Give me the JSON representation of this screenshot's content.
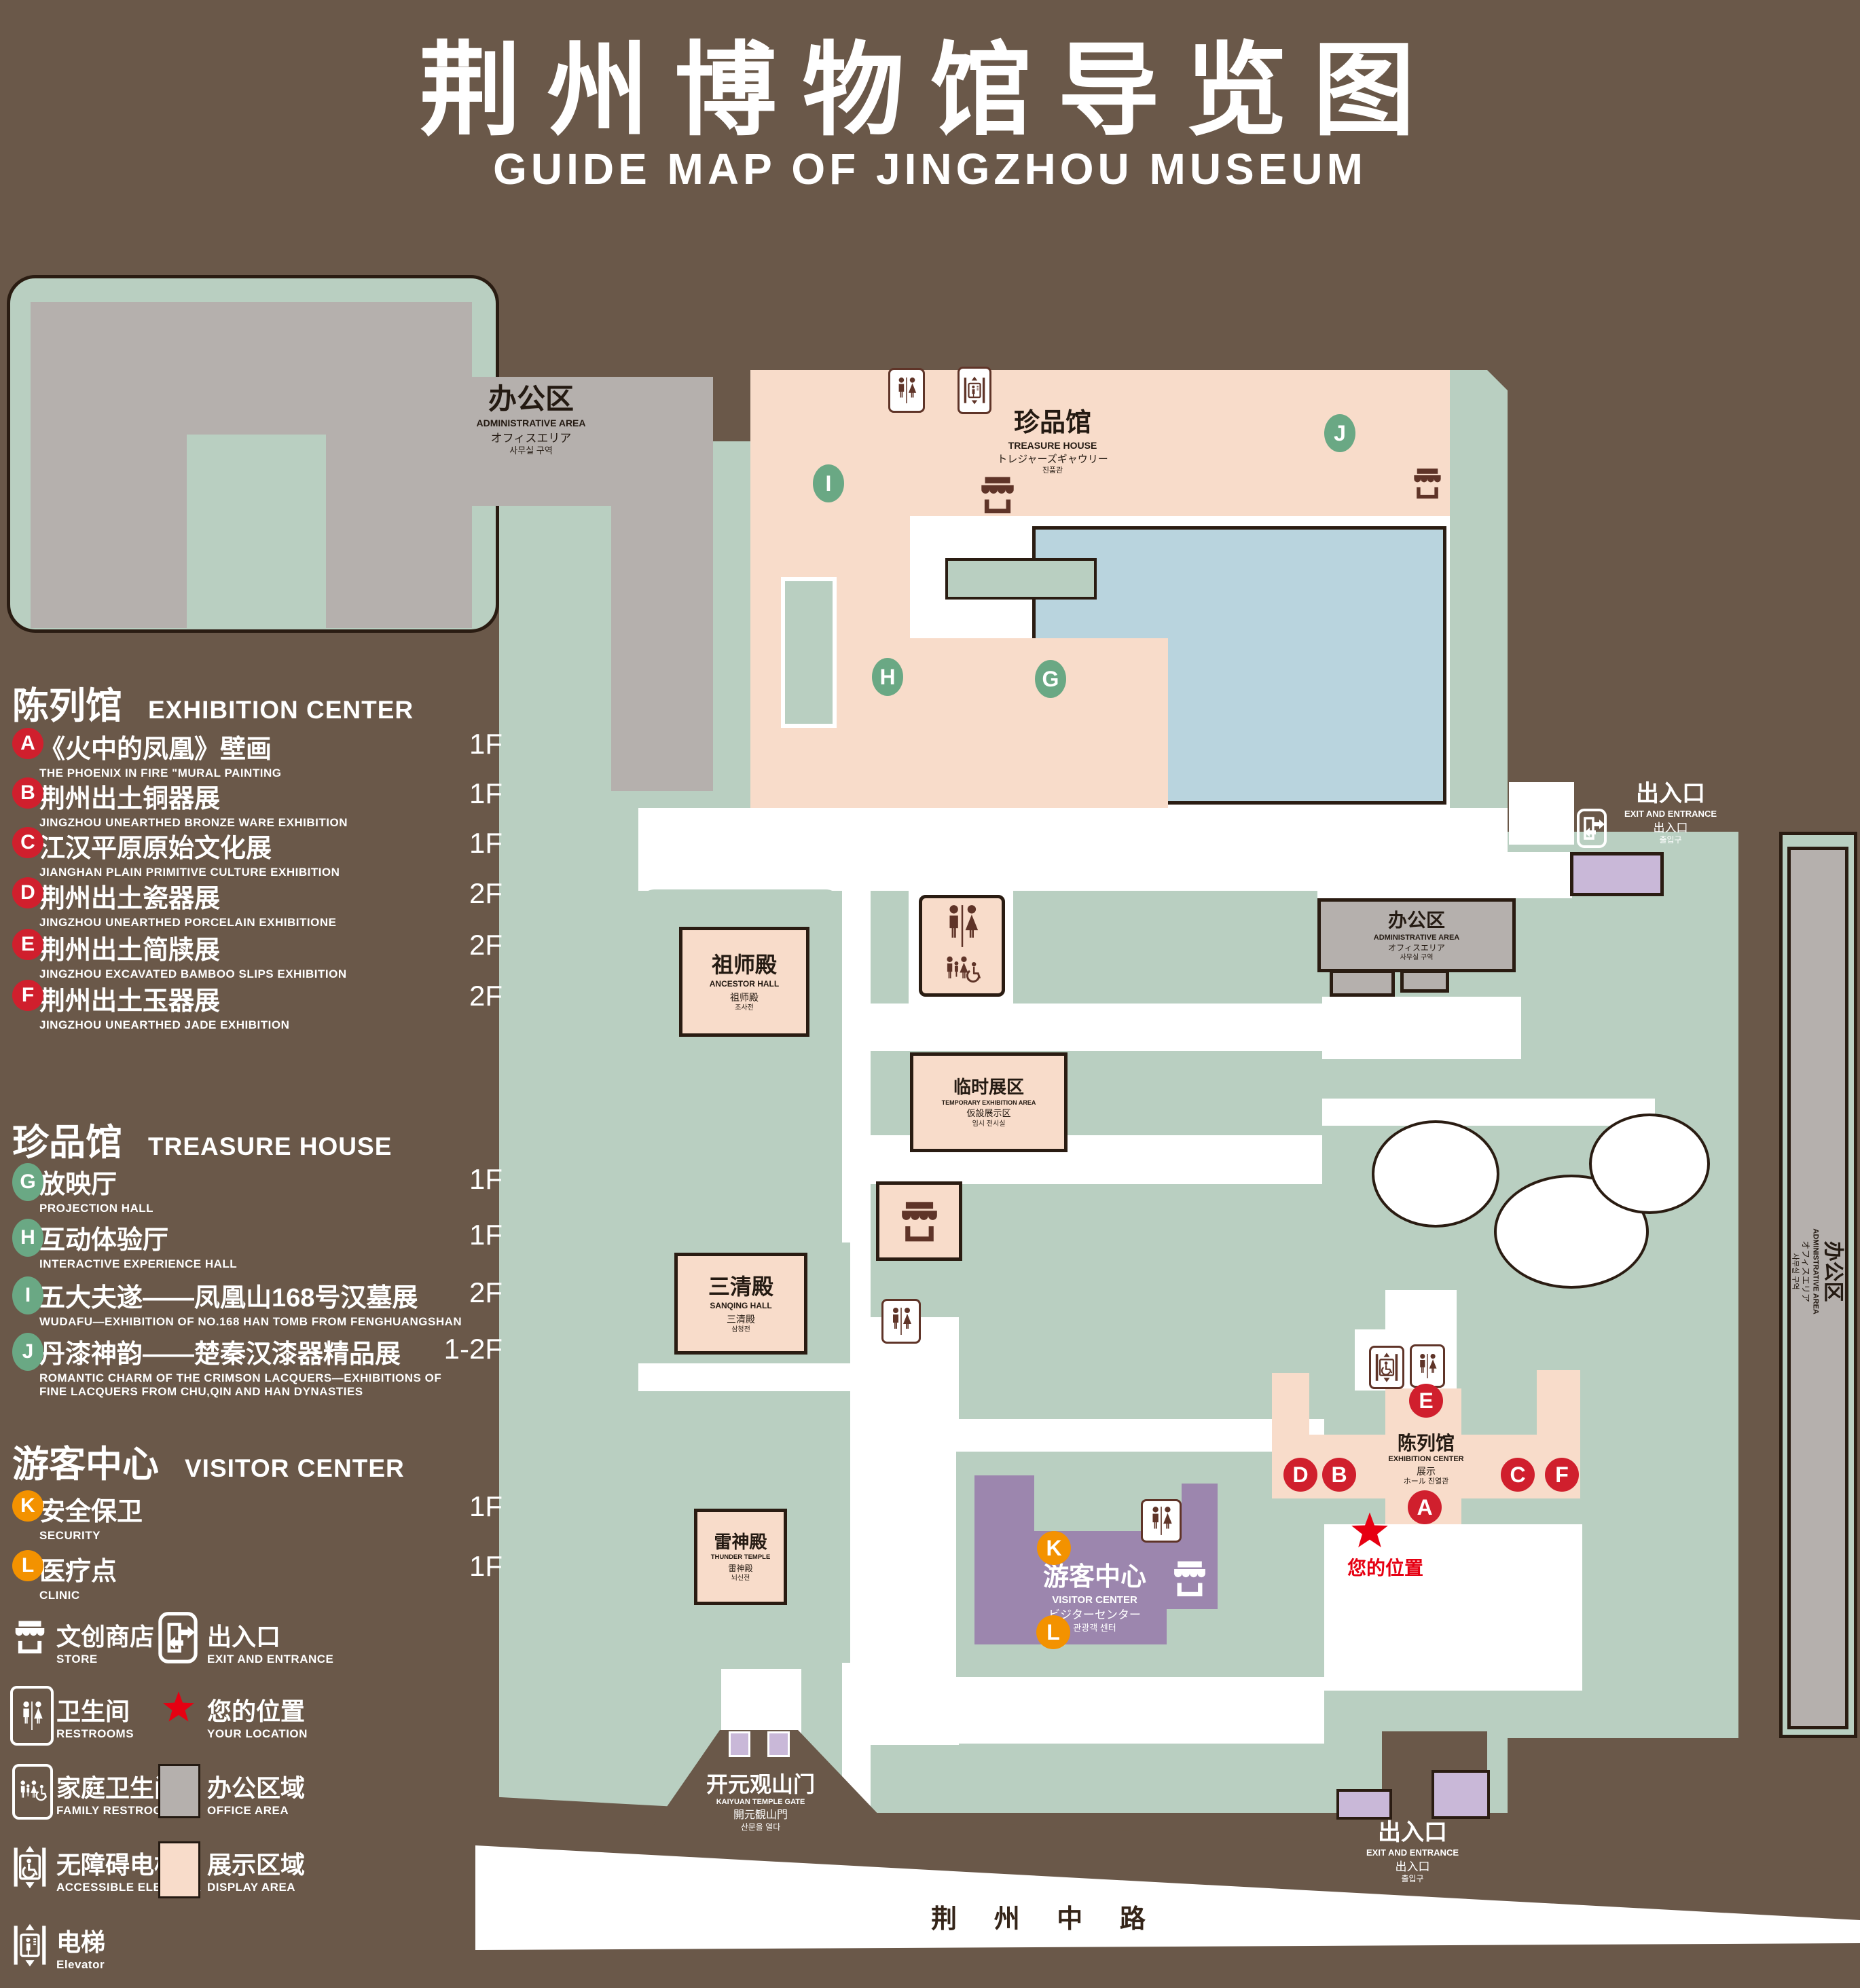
{
  "title": {
    "zh": "荆州博物馆导览图",
    "en": "GUIDE MAP OF JINGZHOU MUSEUM"
  },
  "legend": {
    "exhibition": {
      "zh": "陈列馆",
      "en": "EXHIBITION CENTER",
      "items": [
        {
          "letter": "A",
          "zh": "《火中的凤凰》壁画",
          "en": "THE PHOENIX IN FIRE \"MURAL PAINTING",
          "floor": "1F"
        },
        {
          "letter": "B",
          "zh": "荆州出土铜器展",
          "en": "JINGZHOU UNEARTHED BRONZE WARE EXHIBITION",
          "floor": "1F"
        },
        {
          "letter": "C",
          "zh": "江汉平原原始文化展",
          "en": "JIANGHAN PLAIN PRIMITIVE CULTURE EXHIBITION",
          "floor": "1F"
        },
        {
          "letter": "D",
          "zh": "荆州出土瓷器展",
          "en": "JINGZHOU UNEARTHED PORCELAIN EXHIBITIONE",
          "floor": "2F"
        },
        {
          "letter": "E",
          "zh": "荆州出土简牍展",
          "en": "JINGZHOU EXCAVATED BAMBOO SLIPS EXHIBITION",
          "floor": "2F"
        },
        {
          "letter": "F",
          "zh": "荆州出土玉器展",
          "en": "JINGZHOU UNEARTHED JADE EXHIBITION",
          "floor": "2F"
        }
      ]
    },
    "treasure": {
      "zh": "珍品馆",
      "en": "TREASURE HOUSE",
      "items": [
        {
          "letter": "G",
          "zh": "放映厅",
          "en": "PROJECTION HALL",
          "floor": "1F"
        },
        {
          "letter": "H",
          "zh": "互动体验厅",
          "en": "INTERACTIVE EXPERIENCE HALL",
          "floor": "1F"
        },
        {
          "letter": "I",
          "zh": "五大夫遂——凤凰山168号汉墓展",
          "en": "WUDAFU—EXHIBITION OF NO.168 HAN TOMB FROM FENGHUANGSHAN",
          "floor": "2F"
        },
        {
          "letter": "J",
          "zh": "丹漆神韵——楚秦汉漆器精品展",
          "en": "ROMANTIC CHARM OF THE CRIMSON LACQUERS—EXHIBITIONS OF FINE LACQUERS FROM CHU,QIN AND HAN DYNASTIES",
          "floor": "1-2F"
        }
      ]
    },
    "visitor": {
      "zh": "游客中心",
      "en": "VISITOR CENTER",
      "items": [
        {
          "letter": "K",
          "zh": "安全保卫",
          "en": "SECURITY",
          "floor": "1F"
        },
        {
          "letter": "L",
          "zh": "医疗点",
          "en": "CLINIC",
          "floor": "1F"
        }
      ]
    },
    "icons": {
      "store": {
        "zh": "文创商店",
        "en": "STORE"
      },
      "exit": {
        "zh": "出入口",
        "en": "EXIT AND ENTRANCE"
      },
      "restrooms": {
        "zh": "卫生间",
        "en": "RESTROOMS"
      },
      "location": {
        "zh": "您的位置",
        "en": "YOUR LOCATION"
      },
      "family": {
        "zh": "家庭卫生间",
        "en": "FAMILY RESTROOMS"
      },
      "office": {
        "zh": "办公区域",
        "en": "OFFICE AREA"
      },
      "accessible": {
        "zh": "无障碍电梯",
        "en": "ACCESSIBLE ELEVATOR"
      },
      "display": {
        "zh": "展示区域",
        "en": "DISPLAY AREA"
      },
      "elevator": {
        "zh": "电梯",
        "en": "Elevator"
      }
    }
  },
  "map": {
    "buildings": {
      "admin_tl": {
        "zh": "办公区",
        "en": "ADMINISTRATIVE AREA",
        "ja": "オフィスエリア",
        "ko": "사무실 구역"
      },
      "treasure": {
        "zh": "珍品馆",
        "en": "TREASURE HOUSE",
        "ja": "トレジャーズギャウリー",
        "ko": "진품관"
      },
      "ancestor": {
        "zh": "祖师殿",
        "en": "ANCESTOR HALL",
        "ja": "祖师殿",
        "ko": "조사전"
      },
      "temporary": {
        "zh": "临时展区",
        "en": "TEMPORARY EXHIBITION AREA",
        "ja": "仮設展示区",
        "ko": "임시 전시실"
      },
      "sanqing": {
        "zh": "三清殿",
        "en": "SANQING HALL",
        "ja": "三清殿",
        "ko": "삼청전"
      },
      "thunder": {
        "zh": "雷神殿",
        "en": "THUNDER TEMPLE",
        "ja": "雷神殿",
        "ko": "뇌신전"
      },
      "admin_mid": {
        "zh": "办公区",
        "en": "ADMINISTRATIVE AREA",
        "ja": "オフィスエリア",
        "ko": "사무실 구역"
      },
      "admin_right": {
        "zh": "办公区",
        "en": "ADMINISTRATIVE AREA",
        "ja": "オフィスエリア",
        "ko": "사무실 구역"
      },
      "visitor": {
        "zh": "游客中心",
        "en": "VISITOR CENTER",
        "ja": "ビジターセンター",
        "ko": "관광객 센터"
      },
      "exhibition": {
        "zh": "陈列馆",
        "en": "EXHIBITION CENTER",
        "ja": "展示",
        "ko": "ホール 진열관"
      },
      "gate": {
        "zh": "开元观山门",
        "en": "KAIYUAN TEMPLE GATE",
        "ja": "開元観山門",
        "ko": "산문을 열다"
      }
    },
    "exit_top": {
      "zh": "出入口",
      "en": "EXIT AND ENTRANCE",
      "ja": "出入口",
      "ko": "출입구"
    },
    "exit_bottom": {
      "zh": "出入口",
      "en": "EXIT AND ENTRANCE",
      "ja": "出入口",
      "ko": "출입구"
    },
    "road": "荆 州 中 路",
    "your_location": "您的位置",
    "markers": {
      "A": "A",
      "B": "B",
      "C": "C",
      "D": "D",
      "E": "E",
      "F": "F",
      "G": "G",
      "H": "H",
      "I": "I",
      "J": "J",
      "K": "K",
      "L": "L"
    }
  },
  "colors": {
    "background": "#6a5849",
    "green": "#b9cfc1",
    "display_pink": "#f8dcca",
    "office_gray": "#b5b0ad",
    "pond_blue": "#b9d4de",
    "visitor_purple": "#9c86ae",
    "small_purple": "#c9b8d8",
    "marker_red": "#d01f2d",
    "marker_green": "#6aa884",
    "marker_orange": "#f39200",
    "location_red": "#e60012",
    "icon_brown": "#5f3428"
  }
}
